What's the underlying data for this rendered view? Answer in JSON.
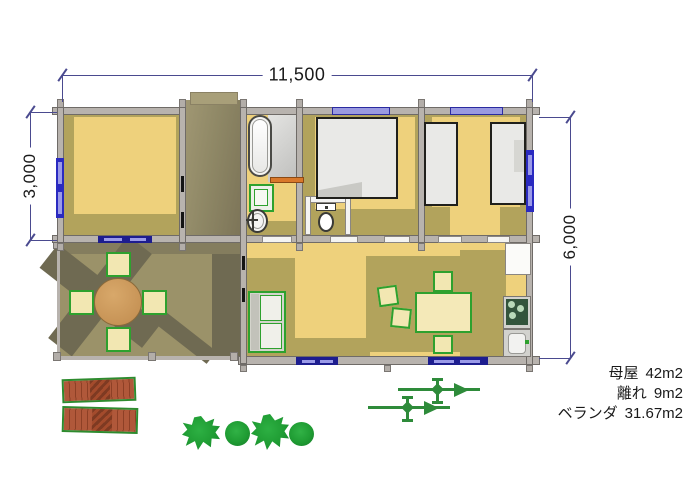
{
  "dimensions": {
    "width_total": "11,500",
    "height_left": "3,000",
    "height_right": "6,000"
  },
  "areas": [
    {
      "label": "母屋",
      "value": "42m2"
    },
    {
      "label": "離れ",
      "value": "9m2"
    },
    {
      "label": "ベランダ",
      "value": "31.67m2"
    }
  ],
  "colors": {
    "floor_yellow": "#eed17c",
    "floor_shadow_olive": "#b2a35c",
    "deck_olive": "#9b9269",
    "deck_shadow": "#6f6a52",
    "wall_gray": "#b8b3ae",
    "window_blue": "#2a2ac0",
    "furniture_outline_green": "#2ea12e",
    "wood_brown": "#b0583a",
    "plant_green": "#1f9c33",
    "dimension_line_navy": "#4a4a8f"
  }
}
